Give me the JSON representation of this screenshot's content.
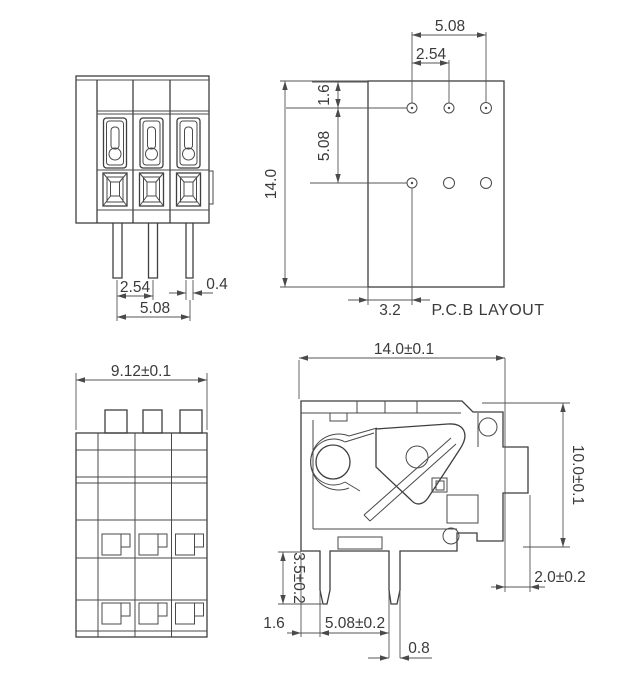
{
  "front_view": {
    "dim_pin_pitch": "2.54",
    "dim_pin_span": "5.08",
    "dim_pin_width": "0.4"
  },
  "pcb_view": {
    "caption": "P.C.B LAYOUT",
    "dim_hole_span": "5.08",
    "dim_hole_pitch": "2.54",
    "dim_top_offset": "1.6",
    "dim_row_pitch": "5.08",
    "dim_height": "14.0",
    "dim_left_offset": "3.2"
  },
  "top_view": {
    "dim_width": "9.12±0.1"
  },
  "side_view": {
    "dim_width": "14.0±0.1",
    "dim_height": "10.0±0.1",
    "dim_tab_depth": "2.0±0.2",
    "dim_pin_length": "3.5±0.2",
    "dim_pin_offset": "1.6",
    "dim_pin_pitch": "5.08±0.2",
    "dim_pin_width": "0.8"
  }
}
